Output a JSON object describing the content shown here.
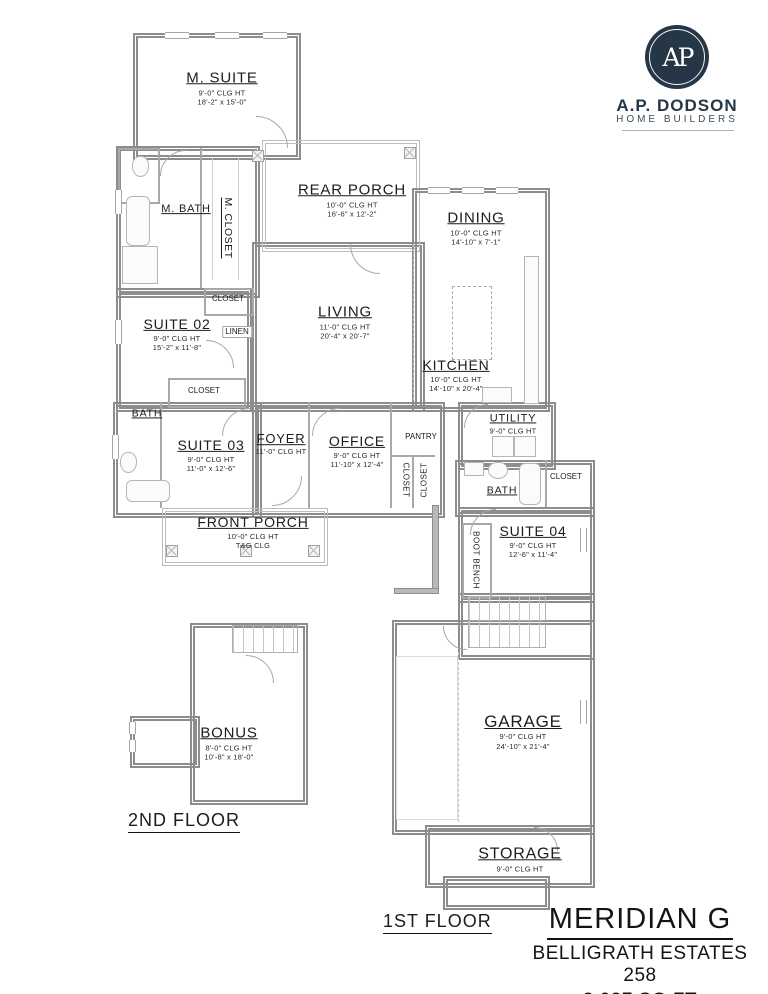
{
  "brand": {
    "monogram": "AP",
    "name": "A.P. DODSON",
    "tagline": "HOME BUILDERS",
    "navy": "#253746"
  },
  "title_block": {
    "plan_name": "MERIDIAN G",
    "community": "BELLIGRATH ESTATES 258",
    "area": "3,037 SQ FT"
  },
  "floor_labels": {
    "first": "1ST FLOOR",
    "second": "2ND FLOOR"
  },
  "rooms": {
    "m_suite": {
      "name": "M. SUITE",
      "clg": "9'-0\" CLG HT",
      "dims": "18'-2\" x 15'-0\""
    },
    "rear_porch": {
      "name": "REAR PORCH",
      "clg": "10'-0\" CLG HT",
      "dims": "16'-6\" x 12'-2\""
    },
    "dining": {
      "name": "DINING",
      "clg": "10'-0\" CLG HT",
      "dims": "14'-10\" x 7'-1\""
    },
    "living": {
      "name": "LIVING",
      "clg": "11'-0\" CLG HT",
      "dims": "20'-4\" x 20'-7\""
    },
    "kitchen": {
      "name": "KITCHEN",
      "clg": "10'-0\" CLG HT",
      "dims": "14'-10\" x 20'-4\""
    },
    "m_bath": {
      "name": "M. BATH"
    },
    "m_closet": {
      "name": "M. CLOSET"
    },
    "closet_hall": {
      "name": "CLOSET"
    },
    "suite_02": {
      "name": "SUITE 02",
      "clg": "9'-0\" CLG HT",
      "dims": "15'-2\" x 11'-8\""
    },
    "linen": {
      "name": "LINEN"
    },
    "closet_suite03": {
      "name": "CLOSET"
    },
    "bath_main": {
      "name": "BATH"
    },
    "suite_03": {
      "name": "SUITE 03",
      "clg": "9'-0\" CLG HT",
      "dims": "11'-0\" x 12'-6\""
    },
    "foyer": {
      "name": "FOYER",
      "clg": "11'-0\" CLG HT"
    },
    "office": {
      "name": "OFFICE",
      "clg": "9'-0\" CLG HT",
      "dims": "11'-10\" x 12'-4\""
    },
    "pantry": {
      "name": "PANTRY"
    },
    "closet_foyer_a": {
      "name": "CLOSET"
    },
    "closet_foyer_b": {
      "name": "CLOSET"
    },
    "utility": {
      "name": "UTILITY",
      "clg": "9'-0\" CLG HT"
    },
    "bath_hall": {
      "name": "BATH"
    },
    "closet_suite04": {
      "name": "CLOSET"
    },
    "suite_04": {
      "name": "SUITE 04",
      "clg": "9'-0\" CLG HT",
      "dims": "12'-6\" x 11'-4\""
    },
    "boot_bench": {
      "name": "BOOT BENCH"
    },
    "front_porch": {
      "name": "FRONT PORCH",
      "clg": "10'-0\" CLG HT",
      "extra": "T&G CLG"
    },
    "garage": {
      "name": "GARAGE",
      "clg": "9'-0\" CLG HT",
      "dims": "24'-10\" x 21'-4\""
    },
    "storage": {
      "name": "STORAGE",
      "clg": "9'-0\" CLG HT"
    },
    "bonus": {
      "name": "BONUS",
      "clg": "8'-0\" CLG HT",
      "dims": "10'-8\" x 18'-0\""
    }
  }
}
